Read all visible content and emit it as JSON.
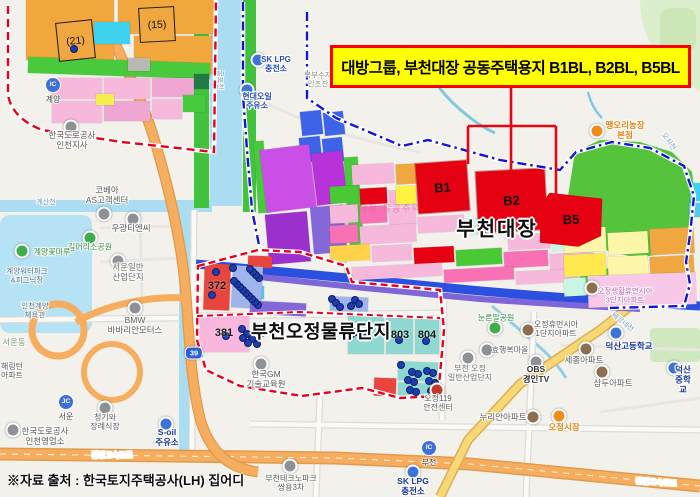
{
  "banner": {
    "text": "대방그룹, 부천대장 공동주택용지 B1BL, B2BL, B5BL",
    "bg": "#ffff00",
    "border": "#ff0000"
  },
  "source": {
    "text": "※자료 출처 : 한국토지주택공사(LH) 집어디"
  },
  "district_labels": {
    "daejang": "부천대장",
    "ojeong": "부천오정물류단지",
    "watermark": "대장 공공주택지구"
  },
  "blocks": {
    "b1": "B1",
    "b2": "B2",
    "b5": "B5",
    "z21": "(21)",
    "z15": "(15)"
  },
  "zone_numbers": [
    [
      217,
      286,
      "372"
    ],
    [
      224,
      333,
      "381"
    ],
    [
      400,
      335,
      "803"
    ],
    [
      427,
      335,
      "804"
    ]
  ],
  "colors": {
    "block_red": "#e50012",
    "boundary_red": "#e8001c",
    "boundary_blue": "#1313d9",
    "banner_yellow": "#ffff00",
    "expressway_orange": "#f6ad5e",
    "water_blue": "#aadcf2"
  },
  "parcels": [
    [
      26,
      0,
      88,
      60,
      "#f2a73c",
      0
    ],
    [
      118,
      0,
      96,
      34,
      "#f2a73c",
      0
    ],
    [
      94,
      22,
      36,
      22,
      "#3fd2ee",
      0
    ],
    [
      134,
      36,
      78,
      38,
      "#f2a73c",
      0
    ],
    [
      28,
      60,
      182,
      16,
      "#49c93c",
      2
    ],
    [
      128,
      58,
      22,
      13,
      "#b9b9b3",
      0
    ],
    [
      52,
      78,
      50,
      21,
      "#f6b9dc",
      0
    ],
    [
      104,
      78,
      46,
      21,
      "#f6b9dc",
      0
    ],
    [
      152,
      78,
      42,
      19,
      "#f0a6d2",
      0
    ],
    [
      52,
      101,
      50,
      22,
      "#f6b9dc",
      0
    ],
    [
      104,
      101,
      46,
      20,
      "#f0a6d2",
      0
    ],
    [
      152,
      99,
      30,
      20,
      "#f6b9dc",
      0
    ],
    [
      96,
      94,
      18,
      11,
      "#f3ee4b",
      0
    ],
    [
      194,
      74,
      15,
      15,
      "#1f7a45",
      0
    ],
    [
      183,
      95,
      22,
      17,
      "#49c93c",
      0
    ],
    [
      301,
      111,
      21,
      24,
      "#3d63e8",
      -6
    ],
    [
      324,
      112,
      20,
      23,
      "#3d63e8",
      -6
    ],
    [
      300,
      137,
      21,
      25,
      "#3d63e8",
      -6
    ],
    [
      323,
      138,
      20,
      24,
      "#3d63e8",
      -6
    ],
    [
      256,
      141,
      10,
      72,
      "#49c93c",
      -4
    ],
    [
      263,
      147,
      50,
      63,
      "#c94fe6",
      -7
    ],
    [
      314,
      152,
      31,
      52,
      "#b832d9",
      -7
    ],
    [
      267,
      213,
      42,
      50,
      "#9b30cc",
      -5
    ],
    [
      312,
      206,
      33,
      47,
      "#8468d9",
      -5
    ],
    [
      347,
      157,
      14,
      96,
      "#49c93c",
      -4
    ],
    [
      330,
      186,
      28,
      17,
      "#49c936",
      -3
    ],
    [
      360,
      188,
      27,
      16,
      "#e50012",
      -3
    ],
    [
      389,
      190,
      27,
      16,
      "#f6b9dc",
      -3
    ],
    [
      330,
      205,
      28,
      18,
      "#f6b9dc",
      -3
    ],
    [
      360,
      206,
      27,
      17,
      "#f871b4",
      -3
    ],
    [
      389,
      208,
      27,
      17,
      "#f6b9dc",
      -3
    ],
    [
      330,
      225,
      28,
      18,
      "#f871b4",
      -3
    ],
    [
      360,
      225,
      56,
      18,
      "#f6b9dc",
      -3
    ],
    [
      330,
      245,
      40,
      16,
      "#ffd24a",
      -3
    ],
    [
      372,
      245,
      40,
      16,
      "#f6b9dc",
      -3
    ],
    [
      414,
      247,
      40,
      16,
      "#e50012",
      -3
    ],
    [
      456,
      249,
      46,
      16,
      "#49c936",
      -3
    ],
    [
      504,
      251,
      44,
      16,
      "#f871b4",
      -3
    ],
    [
      550,
      253,
      44,
      16,
      "#f6b9dc",
      -3
    ],
    [
      418,
      216,
      46,
      16,
      "#f6b9dc",
      -3
    ],
    [
      466,
      218,
      40,
      16,
      "#c9f7e3",
      -3
    ],
    [
      508,
      234,
      42,
      15,
      "#f6b9dc",
      -3
    ],
    [
      552,
      235,
      40,
      15,
      "#c9f7e3",
      -3
    ],
    [
      352,
      265,
      90,
      13,
      "#f6b9dc",
      -3
    ],
    [
      444,
      268,
      70,
      13,
      "#f871b4",
      -3
    ],
    [
      516,
      270,
      62,
      13,
      "#f6b9dc",
      -3
    ],
    [
      580,
      269,
      40,
      14,
      "#49c936",
      -3
    ],
    [
      396,
      164,
      20,
      20,
      "#f0a73f",
      -3
    ],
    [
      352,
      164,
      42,
      20,
      "#f6b9dc",
      -3
    ],
    [
      396,
      186,
      20,
      18,
      "#fff341",
      -3
    ],
    [
      564,
      228,
      42,
      24,
      "#fdf6a8",
      -3
    ],
    [
      608,
      232,
      40,
      22,
      "#fdf6a8",
      -3
    ],
    [
      650,
      228,
      44,
      26,
      "#f0a73f",
      -3
    ],
    [
      564,
      254,
      42,
      22,
      "#ffe94e",
      -3
    ],
    [
      608,
      256,
      40,
      20,
      "#fdf6a8",
      -3
    ],
    [
      650,
      256,
      44,
      20,
      "#f0a73f",
      -3
    ],
    [
      564,
      278,
      22,
      18,
      "#c9f7e3",
      -3
    ],
    [
      588,
      274,
      108,
      32,
      "#f8c8e8",
      -2
    ],
    [
      690,
      183,
      10,
      18,
      "#3fd2ee",
      0
    ],
    [
      689,
      203,
      11,
      14,
      "#56c8e8",
      0
    ],
    [
      204,
      264,
      26,
      46,
      "#e8453f",
      2
    ],
    [
      248,
      256,
      24,
      12,
      "#e8453f",
      2
    ],
    [
      251,
      286,
      13,
      13,
      "#56c8e8",
      0
    ],
    [
      232,
      266,
      30,
      42,
      "#9fb4ea",
      3
    ],
    [
      199,
      315,
      50,
      37,
      "#f9b7dd",
      0
    ],
    [
      250,
      302,
      56,
      13,
      "#8468d9",
      3
    ],
    [
      348,
      316,
      36,
      38,
      "#8fd8d2",
      0
    ],
    [
      386,
      318,
      27,
      36,
      "#8fd8d2",
      0
    ],
    [
      415,
      318,
      24,
      36,
      "#8fd8d2",
      0
    ],
    [
      398,
      362,
      42,
      19,
      "#8fd8d2",
      2
    ],
    [
      398,
      383,
      42,
      13,
      "#8fd8d2",
      2
    ],
    [
      374,
      378,
      22,
      18,
      "#e8453f",
      2
    ],
    [
      330,
      297,
      38,
      14,
      "#9fb4ea",
      2
    ]
  ],
  "labels": [
    [
      46,
      203,
      "계산천",
      7,
      "#6f9ec2",
      400,
      0
    ],
    [
      219,
      80,
      "굴포천",
      7,
      "#6f9ec2",
      400,
      90
    ],
    [
      276,
      64,
      "SK LPG\n충전소",
      8,
      "#2b4fc0",
      700,
      0
    ],
    [
      257,
      101,
      "현대오일\n주유소",
      8,
      "#2b4fc0",
      700,
      0
    ],
    [
      318,
      80,
      "북부수자\n인조잔",
      7.5,
      "#8a8a84",
      400,
      0
    ],
    [
      683,
      62,
      "인서\n골재",
      7.5,
      "#98a090",
      400,
      0
    ],
    [
      668,
      142,
      "오쇠천",
      7,
      "#6f9ec2",
      400,
      55
    ],
    [
      625,
      131,
      "땡오리농장\n본점",
      8.5,
      "#e8820c",
      700,
      0
    ],
    [
      107,
      196,
      "코베아\nAS고객센터",
      8.5,
      "#5a5a5a",
      400,
      0
    ],
    [
      131,
      229,
      "우광티엔씨",
      8.5,
      "#5a5a5a",
      400,
      0
    ],
    [
      90,
      247,
      "길머리소공원",
      8,
      "#2e8b3a",
      400,
      0
    ],
    [
      52,
      252,
      "계양꽃마루",
      8,
      "#2e8b3a",
      400,
      0
    ],
    [
      27,
      276,
      "계양워터파크\n&피그닉장",
      7.5,
      "#49708e",
      400,
      0
    ],
    [
      128,
      273,
      "서운일반\n산업단지",
      8.5,
      "#6a6a64",
      400,
      0
    ],
    [
      72,
      141,
      "한국도로공사\n인천지사",
      8.5,
      "#5a5a5a",
      400,
      0
    ],
    [
      35,
      311,
      "인천계양\n체육관",
      7.5,
      "#49708e",
      400,
      0
    ],
    [
      14,
      343,
      "서운동",
      8.5,
      "#7d9a70",
      400,
      0
    ],
    [
      12,
      371,
      "해링턴\n아파트",
      8,
      "#5a5a5a",
      400,
      0
    ],
    [
      135,
      326,
      "BMW\n바바리안모터스",
      8.5,
      "#5a5a5a",
      400,
      0
    ],
    [
      105,
      422,
      "청기와\n장례식장",
      8,
      "#5a5a5a",
      400,
      0
    ],
    [
      167,
      438,
      "S-oil\n주유소",
      8.5,
      "#16369e",
      700,
      0
    ],
    [
      45,
      437,
      "한국도로공사\n인천영업소",
      8.5,
      "#5a5a5a",
      400,
      0
    ],
    [
      112,
      456,
      "경인고속도로",
      7.5,
      "#ffffff",
      700,
      0
    ],
    [
      656,
      483,
      "경인고속도로",
      7.5,
      "#ffffff",
      700,
      4
    ],
    [
      266,
      380,
      "한국GM\n기술교육원",
      8.5,
      "#5a5a5a",
      400,
      0
    ],
    [
      438,
      403,
      "오정119\n안전센터",
      8,
      "#5a5a5a",
      400,
      0
    ],
    [
      503,
      418,
      "누리안아파트",
      8.5,
      "#5a5a5a",
      400,
      0
    ],
    [
      564,
      428,
      "오정시장",
      8.5,
      "#e8820c",
      700,
      0
    ],
    [
      413,
      487,
      "SK LPG\n충전소",
      8.5,
      "#16369e",
      700,
      0
    ],
    [
      291,
      483,
      "부천테크노파크\n쌍용3차",
      8,
      "#5a5a5a",
      400,
      0
    ],
    [
      496,
      318,
      "눈른말공원",
      8,
      "#2e8b3a",
      400,
      0
    ],
    [
      625,
      296,
      "오정생활휴먼시아\n3단지아파트",
      7.5,
      "#c75fae",
      400,
      0
    ],
    [
      556,
      329,
      "오정휴먼시아\n1단지아파트",
      8,
      "#5a5a5a",
      400,
      0
    ],
    [
      510,
      350,
      "효행복마을",
      8,
      "#5a5a5a",
      400,
      0
    ],
    [
      629,
      347,
      "덕산고등학교",
      8.5,
      "#16369e",
      700,
      0
    ],
    [
      584,
      361,
      "세종아파트",
      8.5,
      "#5a5a5a",
      400,
      0
    ],
    [
      536,
      375,
      "OBS\n경인TV",
      8.5,
      "#333333",
      700,
      0
    ],
    [
      470,
      373,
      "부천 오정\n일반산업단지",
      8,
      "#6a6a64",
      400,
      0
    ],
    [
      613,
      384,
      "삼두아파트",
      8.5,
      "#5a5a5a",
      400,
      0
    ],
    [
      683,
      380,
      "덕산중학교",
      8.5,
      "#16369e",
      700,
      0
    ],
    [
      622,
      323,
      "베르네천",
      7,
      "#6f9ec2",
      400,
      38
    ]
  ],
  "markers": [
    [
      258,
      60,
      "#3f74d6"
    ],
    [
      247,
      90,
      "#3f74d6"
    ],
    [
      104,
      214,
      "#8e9296"
    ],
    [
      133,
      219,
      "#8e9296"
    ],
    [
      90,
      238,
      "#3fae4a"
    ],
    [
      22,
      251,
      "#3fae4a"
    ],
    [
      118,
      261,
      "#8e9296"
    ],
    [
      71,
      127,
      "#8e9296"
    ],
    [
      135,
      308,
      "#8e9296"
    ],
    [
      105,
      408,
      "#8e9296"
    ],
    [
      166,
      424,
      "#3f74d6"
    ],
    [
      13,
      430,
      "#8e9296"
    ],
    [
      261,
      364,
      "#8e9296"
    ],
    [
      437,
      390,
      "#c0392b"
    ],
    [
      533,
      417,
      "#8d6e4e"
    ],
    [
      559,
      416,
      "#ef8c1a"
    ],
    [
      413,
      472,
      "#3f74d6"
    ],
    [
      290,
      466,
      "#8e9296"
    ],
    [
      495,
      328,
      "#3fae4a"
    ],
    [
      592,
      288,
      "#8d6e4e"
    ],
    [
      528,
      330,
      "#8d6e4e"
    ],
    [
      487,
      350,
      "#8e9296"
    ],
    [
      616,
      333,
      "#3f74d6"
    ],
    [
      586,
      349,
      "#8d6e4e"
    ],
    [
      536,
      362,
      "#8e9296"
    ],
    [
      468,
      358,
      "#8e9296"
    ],
    [
      602,
      372,
      "#8d6e4e"
    ],
    [
      674,
      368,
      "#3f74d6"
    ],
    [
      597,
      131,
      "#ef8c1a"
    ]
  ],
  "badges": [
    {
      "kind": "IC",
      "name": "계양",
      "x": 53,
      "y": 91
    },
    {
      "kind": "JC",
      "name": "서운",
      "x": 66,
      "y": 408
    },
    {
      "kind": "IC",
      "name": "부천",
      "x": 429,
      "y": 454
    }
  ],
  "route_badges": [
    {
      "label": "39",
      "x": 194,
      "y": 353
    }
  ],
  "dots": {
    "clusters": [
      [
        233,
        268,
        28,
        40,
        14
      ],
      [
        242,
        329,
        24,
        16,
        7
      ],
      [
        347,
        331,
        22,
        18,
        6
      ],
      [
        401,
        365,
        36,
        28,
        12
      ],
      [
        332,
        299,
        34,
        10,
        6
      ]
    ],
    "single": [
      [
        216,
        272
      ],
      [
        212,
        295
      ],
      [
        226,
        336
      ],
      [
        399,
        340
      ],
      [
        426,
        341
      ],
      [
        74,
        49
      ],
      [
        362,
        336
      ]
    ]
  }
}
